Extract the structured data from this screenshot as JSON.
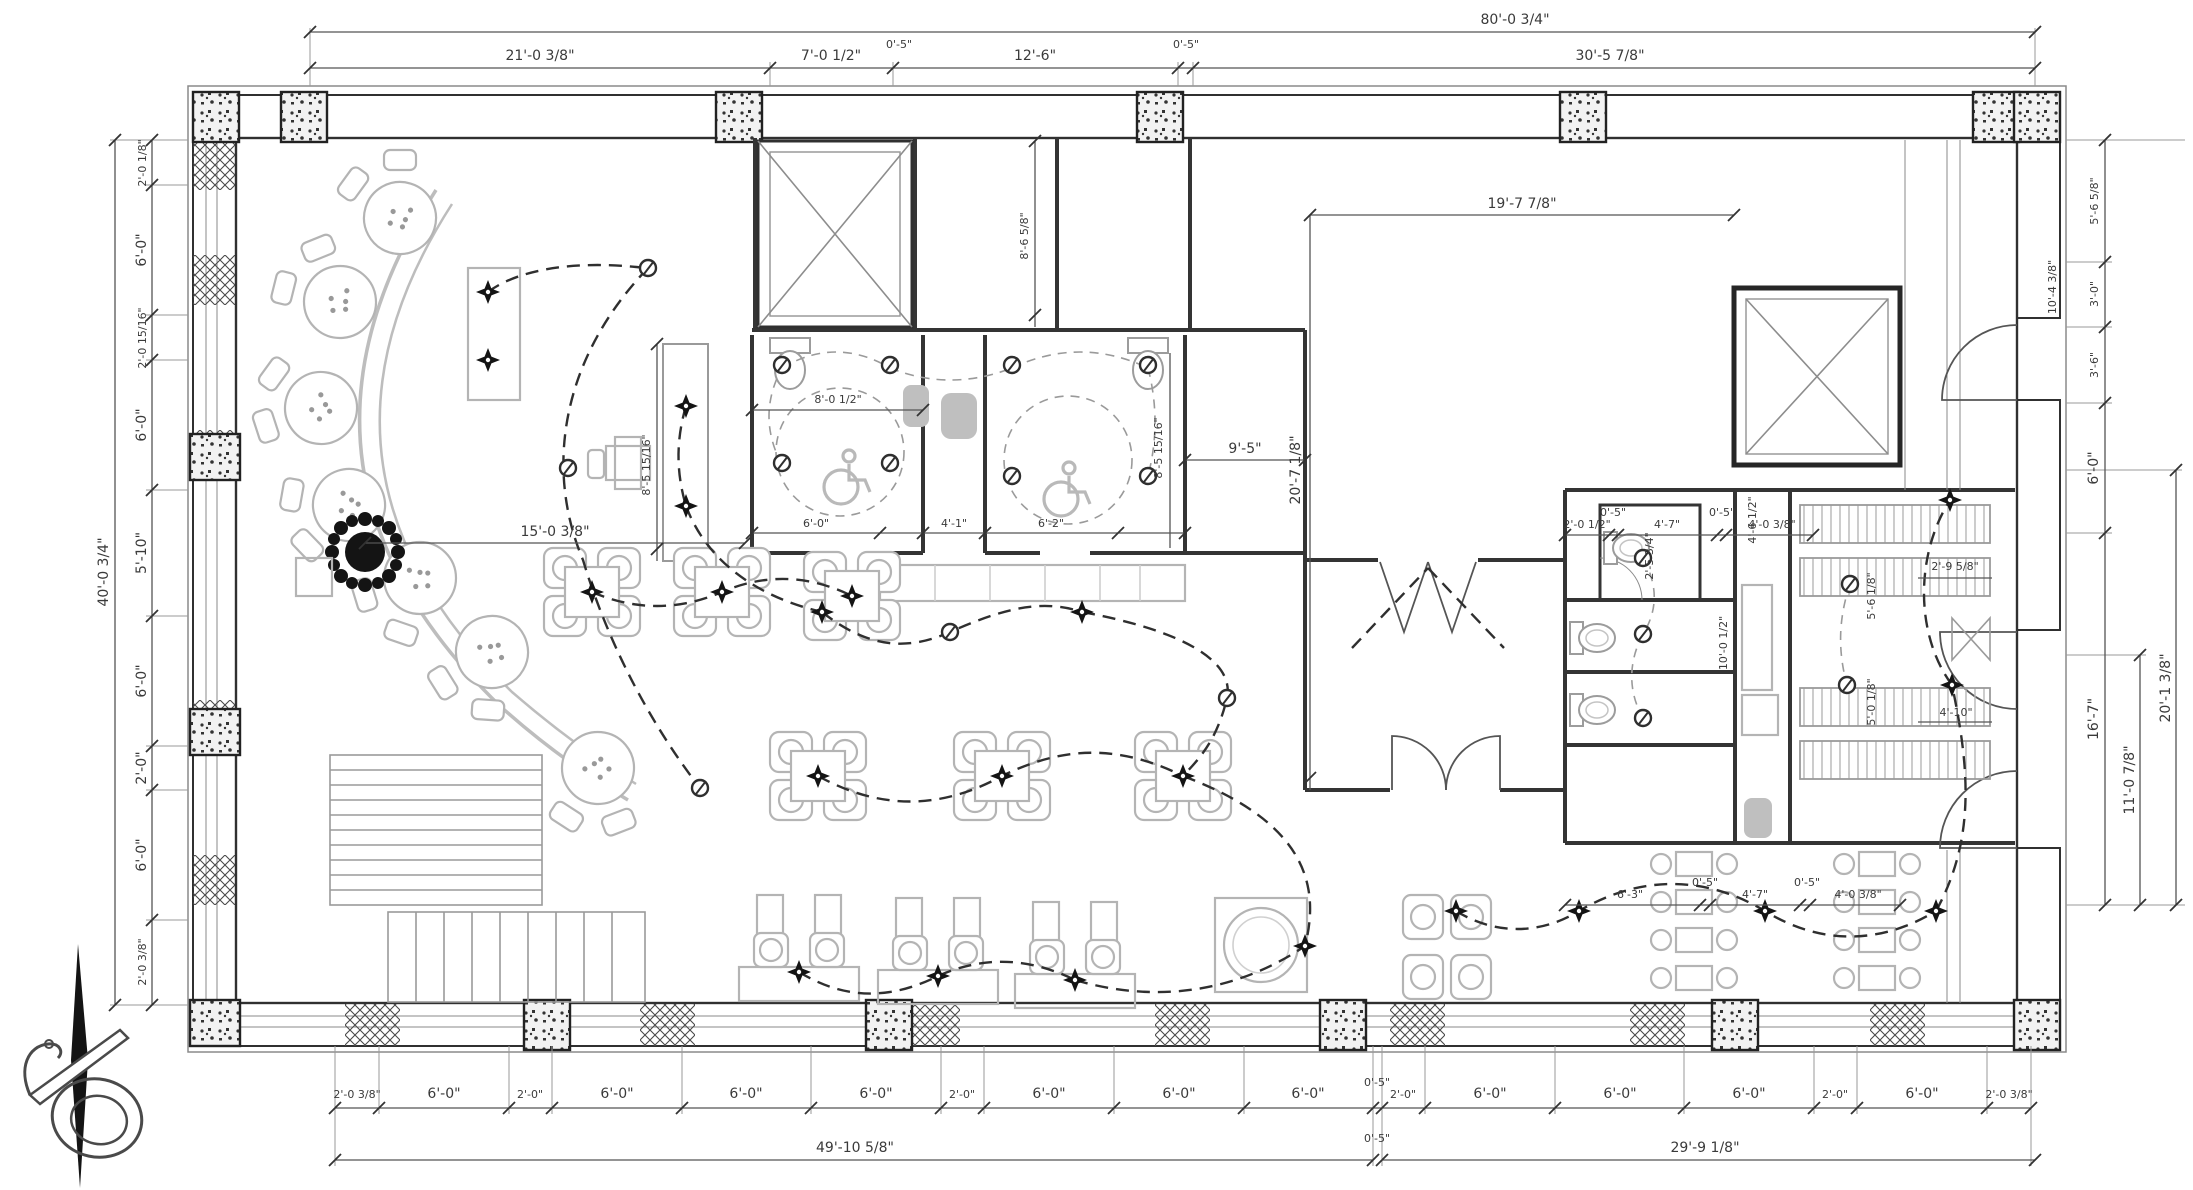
{
  "dims": {
    "overall_width": "80'-0 3/4\"",
    "overall_height": "40'-0 3/4\"",
    "top": [
      "21'-0 3/8\"",
      "7'-0 1/2\"",
      "0'-5\"",
      "12'-6\"",
      "0'-5\"",
      "30'-5 7/8\""
    ],
    "left": [
      "2'-0 1/8\"",
      "6'-0\"",
      "2'-0 15/16\"",
      "6'-0\"",
      "5'-10\"",
      "6'-0\"",
      "2'-0\"",
      "6'-0\"",
      "2'-0 3/8\""
    ],
    "right": [
      "5'-6 5/8\"",
      "3'-0\"",
      "3'-6\"",
      "6'-0\"",
      "16'-7\""
    ],
    "right_outer": [
      "11'-0 7/8\"",
      "20'-1 3/8\""
    ],
    "right_door": "10'-4 3/8\"",
    "bottom": [
      "2'-0 3/8\"",
      "6'-0\"",
      "2'-0\"",
      "6'-0\"",
      "6'-0\"",
      "6'-0\"",
      "2'-0\"",
      "6'-0\"",
      "6'-0\"",
      "6'-0\"",
      "0'-5\"",
      "2'-0\"",
      "6'-0\"",
      "6'-0\"",
      "6'-0\"",
      "2'-0\"",
      "6'-0\"",
      "2'-0 3/8\""
    ],
    "bottom_totals": {
      "left": "49'-10 5/8\"",
      "mid": "0'-5\"",
      "right": "29'-9 1/8\""
    },
    "interior": {
      "banquette_radius": "15'-0 3/8\"",
      "station_height": "8'-5 15/16\"",
      "restroom_width": "8'-0 1/2\"",
      "restroom_left": "6'-0\"",
      "restroom_hall": "4'-1\"",
      "restroom_right": "6'-2\"",
      "room_right": "9'-5\"",
      "rooms_top": "8'-6 5/8\"",
      "kitchen_width": "19'-7 7/8\"",
      "kitchen_height": "20'-7 1/8\"",
      "restroom2_height": "8'-5 15/16\"",
      "wc_top": [
        "2'-0 1/2\"",
        "0'-5\"",
        "4'-7\"",
        "0'-5\"",
        "4'-0 3/8\""
      ],
      "wc_bottom": [
        "6'-3\"",
        "0'-5\"",
        "4'-7\"",
        "0'-5\"",
        "4'-0 3/8\""
      ],
      "wc_room": "2'-5 3/4\"",
      "wc_vanity": "10'-0 1/2\"",
      "booth_a": "5'-6 1/8\"",
      "booth_b": "5'-0 1/8\"",
      "booth_right": "2'-9 5/8\"",
      "booth_right2": "4'-10\"",
      "kitchen_door": "4'-6 1/2\""
    }
  },
  "symbols": {
    "fixture": "diamond-ceiling-light",
    "switch": "switch-outlet",
    "plant": "potted-plant",
    "north": "north-arrow",
    "shaft": "elevator-shaft",
    "ada": "wheelchair-clearance"
  },
  "colors": {
    "line": "#303030",
    "dim": "#555555",
    "furniture": "#b4b4b4",
    "fixture_gray": "#bfbfbf",
    "black": "#141414"
  }
}
